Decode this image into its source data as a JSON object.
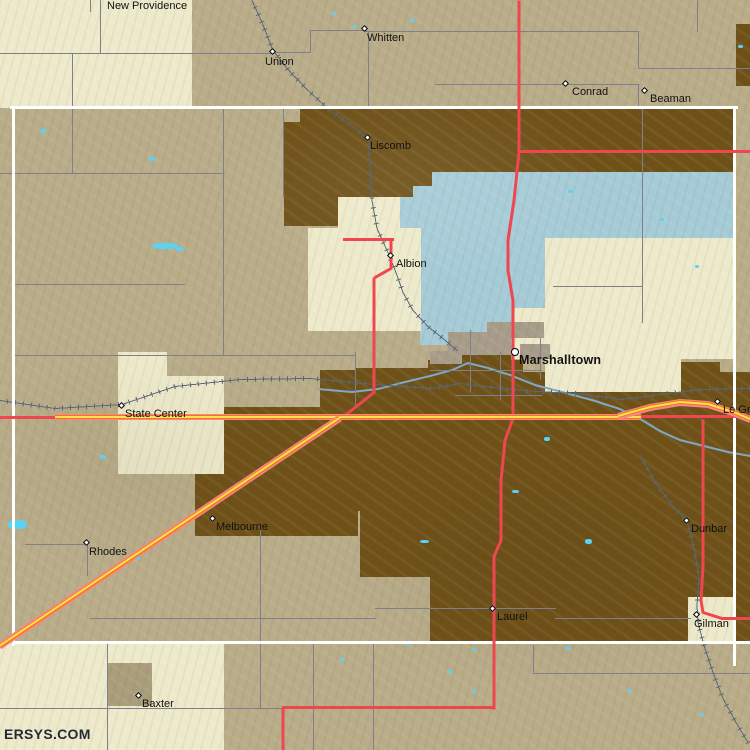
{
  "site": {
    "watermark": "ERSYS.COM"
  },
  "map": {
    "colors": {
      "base_tan": "#B9AC89",
      "cream": "#EDEACB",
      "dark_brown": "#6F5118",
      "light_blue": "#A5CBD7",
      "lake_cyan": "#5BD2F5",
      "tan_dark": "#AA9D7B",
      "city_gray": "#A79C89",
      "gray_road": "#80808C",
      "rail": "#5A6876",
      "river": "#7FA9C9",
      "red_road": "#EF4650",
      "highway_casing": "#F8858B",
      "highway_orange": "#F07818",
      "highway_yellow": "#FFE14D",
      "county_boundary": "#FFFFFF",
      "label_text": "#111111"
    },
    "patches": {
      "brown": [
        [
          300,
          108,
          436,
          64
        ],
        [
          284,
          122,
          60,
          104
        ],
        [
          344,
          172,
          88,
          30
        ],
        [
          736,
          24,
          14,
          62
        ],
        [
          195,
          407,
          163,
          129
        ],
        [
          355,
          368,
          168,
          143
        ],
        [
          320,
          370,
          36,
          44
        ],
        [
          428,
          360,
          95,
          13
        ],
        [
          455,
          344,
          56,
          26
        ],
        [
          523,
          372,
          227,
          271
        ],
        [
          600,
          362,
          120,
          12
        ],
        [
          360,
          511,
          163,
          66
        ],
        [
          430,
          577,
          93,
          65
        ]
      ],
      "blue": [
        [
          432,
          172,
          304,
          16
        ],
        [
          413,
          186,
          323,
          52
        ],
        [
          398,
          197,
          148,
          110
        ],
        [
          420,
          295,
          94,
          50
        ],
        [
          498,
          305,
          46,
          30
        ]
      ],
      "cream": [
        [
          0,
          0,
          192,
          108
        ],
        [
          338,
          197,
          62,
          34
        ],
        [
          308,
          228,
          113,
          103
        ],
        [
          545,
          238,
          191,
          70
        ],
        [
          513,
          308,
          223,
          51
        ],
        [
          545,
          358,
          136,
          34
        ],
        [
          118,
          352,
          49,
          30
        ],
        [
          118,
          376,
          106,
          98
        ],
        [
          688,
          597,
          47,
          46
        ],
        [
          0,
          643,
          224,
          107
        ]
      ],
      "tanDark": [
        [
          107,
          663,
          45,
          43
        ]
      ],
      "city": [
        [
          487,
          322,
          57,
          16
        ],
        [
          448,
          332,
          63,
          23
        ],
        [
          520,
          344,
          30,
          15
        ],
        [
          430,
          351,
          32,
          13
        ]
      ]
    },
    "boundaries": [
      [
        10,
        106,
        728,
        3
      ],
      [
        12,
        106,
        3,
        540
      ],
      [
        733,
        106,
        3,
        560
      ],
      [
        12,
        641,
        738,
        3
      ]
    ],
    "gray_roads": [
      [
        0,
        53,
        274,
        1
      ],
      [
        100,
        0,
        1,
        54
      ],
      [
        273,
        52,
        38,
        1
      ],
      [
        310,
        30,
        1,
        23
      ],
      [
        310,
        30,
        57,
        1
      ],
      [
        365,
        31,
        274,
        1
      ],
      [
        368,
        31,
        1,
        76
      ],
      [
        638,
        31,
        1,
        38
      ],
      [
        638,
        68,
        112,
        1
      ],
      [
        697,
        0,
        1,
        32
      ],
      [
        435,
        84,
        204,
        1
      ],
      [
        638,
        84,
        1,
        23
      ],
      [
        90,
        0,
        1,
        12
      ],
      [
        72,
        54,
        1,
        120
      ],
      [
        0,
        173,
        224,
        1
      ],
      [
        223,
        107,
        1,
        249
      ],
      [
        13,
        284,
        172,
        1
      ],
      [
        13,
        355,
        343,
        1
      ],
      [
        355,
        352,
        1,
        56
      ],
      [
        0,
        708,
        284,
        1
      ],
      [
        107,
        642,
        1,
        108
      ],
      [
        313,
        642,
        1,
        108
      ],
      [
        260,
        530,
        1,
        178
      ],
      [
        533,
        645,
        1,
        29
      ],
      [
        533,
        673,
        217,
        1
      ],
      [
        90,
        618,
        286,
        1
      ],
      [
        375,
        608,
        181,
        1
      ],
      [
        555,
        618,
        136,
        1
      ],
      [
        642,
        107,
        1,
        216
      ],
      [
        553,
        286,
        90,
        1
      ],
      [
        430,
        370,
        112,
        1
      ],
      [
        470,
        330,
        1,
        62
      ],
      [
        540,
        338,
        1,
        42
      ],
      [
        455,
        395,
        87,
        1
      ],
      [
        500,
        352,
        1,
        48
      ],
      [
        25,
        544,
        63,
        1
      ],
      [
        87,
        544,
        1,
        32
      ],
      [
        283,
        107,
        1,
        90
      ],
      [
        373,
        642,
        1,
        108
      ]
    ],
    "red_roads": [
      [
        519,
        0,
        519,
        152
      ],
      [
        519,
        152,
        514,
        200
      ],
      [
        514,
        200,
        508,
        240
      ],
      [
        508,
        240,
        508,
        270
      ],
      [
        508,
        270,
        513,
        300
      ],
      [
        513,
        300,
        513,
        418
      ],
      [
        513,
        418,
        505,
        440
      ],
      [
        505,
        440,
        501,
        480
      ],
      [
        501,
        480,
        501,
        540
      ],
      [
        501,
        540,
        494,
        556
      ],
      [
        494,
        556,
        494,
        708
      ],
      [
        494,
        707,
        283,
        707
      ],
      [
        283,
        707,
        283,
        750
      ],
      [
        520,
        151,
        750,
        151
      ],
      [
        343,
        239,
        393,
        239
      ],
      [
        391,
        239,
        391,
        268
      ],
      [
        391,
        268,
        375,
        277
      ],
      [
        374,
        277,
        374,
        392
      ],
      [
        374,
        392,
        340,
        419
      ],
      [
        703,
        419,
        703,
        566
      ],
      [
        703,
        566,
        701,
        600
      ],
      [
        701,
        600,
        703,
        612
      ],
      [
        703,
        612,
        722,
        618
      ],
      [
        722,
        618,
        750,
        618
      ],
      [
        640,
        416,
        750,
        416
      ],
      [
        0,
        417,
        56,
        417
      ]
    ],
    "highways": [
      [
        55,
        417,
        640,
        417
      ],
      [
        340,
        418,
        0,
        646
      ],
      [
        618,
        416,
        650,
        407
      ],
      [
        650,
        407,
        680,
        402
      ],
      [
        680,
        402,
        708,
        404
      ],
      [
        708,
        404,
        736,
        413
      ],
      [
        736,
        413,
        750,
        419
      ]
    ],
    "rails": [
      [
        [
          0,
          400
        ],
        [
          55,
          408
        ],
        [
          122,
          404
        ],
        [
          175,
          386
        ],
        [
          240,
          379
        ],
        [
          310,
          378
        ],
        [
          375,
          384
        ],
        [
          432,
          388
        ],
        [
          460,
          383
        ],
        [
          520,
          390
        ],
        [
          575,
          393
        ],
        [
          622,
          399
        ],
        [
          660,
          394
        ],
        [
          702,
          389
        ],
        [
          750,
          388
        ]
      ],
      [
        [
          252,
          0
        ],
        [
          262,
          22
        ],
        [
          273,
          50
        ],
        [
          287,
          68
        ],
        [
          306,
          88
        ],
        [
          330,
          110
        ],
        [
          354,
          127
        ],
        [
          368,
          138
        ],
        [
          370,
          166
        ],
        [
          372,
          200
        ],
        [
          377,
          228
        ],
        [
          388,
          252
        ],
        [
          396,
          272
        ],
        [
          403,
          292
        ],
        [
          413,
          310
        ],
        [
          429,
          327
        ],
        [
          443,
          338
        ],
        [
          457,
          350
        ]
      ],
      [
        [
          640,
          455
        ],
        [
          656,
          483
        ],
        [
          673,
          506
        ],
        [
          687,
          521
        ],
        [
          694,
          548
        ],
        [
          699,
          576
        ],
        [
          697,
          605
        ],
        [
          698,
          622
        ],
        [
          704,
          645
        ],
        [
          713,
          672
        ],
        [
          723,
          698
        ],
        [
          736,
          722
        ],
        [
          748,
          742
        ]
      ]
    ],
    "rivers": [
      [
        [
          318,
          389
        ],
        [
          352,
          392
        ],
        [
          378,
          389
        ],
        [
          405,
          382
        ],
        [
          430,
          376
        ],
        [
          452,
          370
        ],
        [
          468,
          363
        ],
        [
          488,
          368
        ],
        [
          510,
          375
        ],
        [
          535,
          385
        ],
        [
          562,
          392
        ],
        [
          592,
          400
        ],
        [
          620,
          409
        ],
        [
          642,
          420
        ],
        [
          660,
          431
        ],
        [
          680,
          440
        ],
        [
          704,
          446
        ],
        [
          728,
          452
        ],
        [
          750,
          456
        ]
      ]
    ],
    "lakes": [
      [
        40,
        129,
        6,
        4
      ],
      [
        148,
        157,
        7,
        4
      ],
      [
        353,
        25,
        4,
        3
      ],
      [
        410,
        19,
        5,
        3
      ],
      [
        152,
        243,
        26,
        6
      ],
      [
        176,
        247,
        8,
        4
      ],
      [
        100,
        455,
        6,
        4
      ],
      [
        8,
        520,
        19,
        9
      ],
      [
        133,
        556,
        7,
        4
      ],
      [
        544,
        437,
        6,
        4
      ],
      [
        568,
        190,
        5,
        3
      ],
      [
        420,
        540,
        9,
        3
      ],
      [
        585,
        539,
        7,
        5
      ],
      [
        512,
        490,
        7,
        3
      ],
      [
        340,
        658,
        5,
        3
      ],
      [
        405,
        643,
        4,
        3
      ],
      [
        447,
        670,
        5,
        3
      ],
      [
        472,
        648,
        4,
        3
      ],
      [
        472,
        690,
        4,
        3
      ],
      [
        627,
        689,
        4,
        3
      ],
      [
        566,
        647,
        5,
        3
      ],
      [
        700,
        713,
        4,
        3
      ],
      [
        738,
        45,
        5,
        3
      ],
      [
        660,
        218,
        4,
        3
      ],
      [
        695,
        265,
        4,
        3
      ],
      [
        332,
        12,
        4,
        3
      ]
    ],
    "towns": [
      {
        "name": "New Providence",
        "no_marker": true,
        "lx": 107,
        "ly": 1
      },
      {
        "name": "Whitten",
        "x": 365,
        "y": 29,
        "lx": 367,
        "ly": 33
      },
      {
        "name": "Union",
        "x": 273,
        "y": 52,
        "lx": 265,
        "ly": 57
      },
      {
        "name": "Conrad",
        "x": 566,
        "y": 84,
        "lx": 572,
        "ly": 87
      },
      {
        "name": "Beaman",
        "x": 645,
        "y": 91,
        "lx": 650,
        "ly": 94
      },
      {
        "name": "Liscomb",
        "x": 368,
        "y": 138,
        "lx": 370,
        "ly": 141
      },
      {
        "name": "Albion",
        "x": 391,
        "y": 256,
        "lx": 396,
        "ly": 259
      },
      {
        "name": "Marshalltown",
        "x": 515,
        "y": 352,
        "city": true,
        "lx": 519,
        "ly": 355
      },
      {
        "name": "State Center",
        "x": 122,
        "y": 406,
        "lx": 125,
        "ly": 409
      },
      {
        "name": "Le Grand",
        "x": 718,
        "y": 402,
        "lx": 723,
        "ly": 405
      },
      {
        "name": "Melbourne",
        "x": 213,
        "y": 519,
        "lx": 216,
        "ly": 522
      },
      {
        "name": "Rhodes",
        "x": 87,
        "y": 543,
        "lx": 89,
        "ly": 547
      },
      {
        "name": "Dunbar",
        "x": 687,
        "y": 521,
        "lx": 691,
        "ly": 524
      },
      {
        "name": "Laurel",
        "x": 493,
        "y": 609,
        "lx": 497,
        "ly": 612
      },
      {
        "name": "Gilman",
        "x": 697,
        "y": 615,
        "lx": 694,
        "ly": 619
      },
      {
        "name": "Baxter",
        "x": 139,
        "y": 696,
        "lx": 142,
        "ly": 699
      }
    ]
  }
}
